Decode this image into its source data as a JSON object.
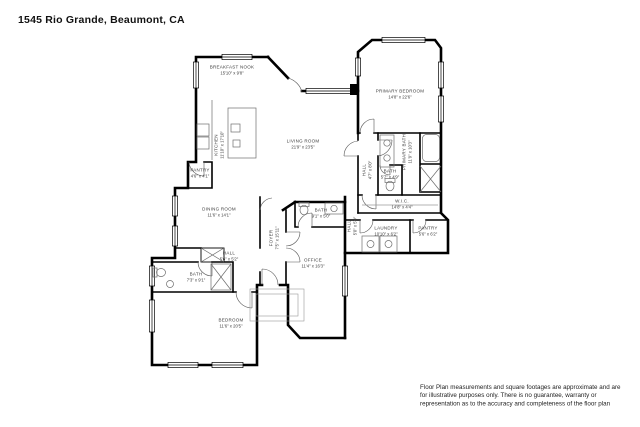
{
  "page": {
    "title": "1545 Rio Grande, Beaumont, CA",
    "disclaimer": "Floor Plan measurements and square footages are approximate and are for illustrative purposes only. There is no guarantee, warranty or representation as to the accuracy and completeness of the floor plan"
  },
  "colors": {
    "background": "#ffffff",
    "wall": "#000000",
    "label": "#3d3d3d",
    "fixture": "#6e6e6e"
  },
  "rooms": [
    {
      "name": "BREAKFAST NOOK",
      "dims": "15'10\" x 9'8\"",
      "x": 232,
      "y": 70,
      "rot": 0
    },
    {
      "name": "KITCHEN",
      "dims": "11'10\" x 17'10\"",
      "x": 219,
      "y": 145,
      "rot": -90
    },
    {
      "name": "LIVING ROOM",
      "dims": "21'9\" x 23'5\"",
      "x": 303,
      "y": 144,
      "rot": 0
    },
    {
      "name": "PRIMARY BEDROOM",
      "dims": "14'8\" x 22'6\"",
      "x": 400,
      "y": 94,
      "rot": 0
    },
    {
      "name": "HALL",
      "dims": "4'7\" x 8'0\"",
      "x": 367,
      "y": 170,
      "rot": -90
    },
    {
      "name": "PRIMARY BATH",
      "dims": "11'9\" x 10'3\"",
      "x": 407,
      "y": 152,
      "rot": -90
    },
    {
      "name": "BATH",
      "dims": "5'7\" x 4'9\"",
      "x": 390,
      "y": 174,
      "rot": 0
    },
    {
      "name": "W.I.C.",
      "dims": "14'8\" x 4'4\"",
      "x": 402,
      "y": 204,
      "rot": 0
    },
    {
      "name": "PANTRY",
      "dims": "4'6\" x 4'1\"",
      "x": 200,
      "y": 173,
      "rot": 0
    },
    {
      "name": "DINING ROOM",
      "dims": "11'6\" x 14'1\"",
      "x": 219,
      "y": 212,
      "rot": 0
    },
    {
      "name": "FOYER",
      "dims": "7'5\" x 15'11\"",
      "x": 274,
      "y": 238,
      "rot": -90
    },
    {
      "name": "BATH",
      "dims": "9'1\" x 5'0\"",
      "x": 321,
      "y": 213,
      "rot": 0
    },
    {
      "name": "HALL",
      "dims": "5'0\" x 5'9\"",
      "x": 352,
      "y": 226,
      "rot": -90
    },
    {
      "name": "LAUNDRY",
      "dims": "10'10\" x 6'2\"",
      "x": 386,
      "y": 231,
      "rot": 0
    },
    {
      "name": "PANTRY",
      "dims": "5'6\" x 6'2\"",
      "x": 428,
      "y": 231,
      "rot": 0
    },
    {
      "name": "HALL",
      "dims": "5'6\" x 5'2\"",
      "x": 229,
      "y": 256,
      "rot": 0
    },
    {
      "name": "OFFICE",
      "dims": "11'4\" x 16'3\"",
      "x": 313,
      "y": 263,
      "rot": 0
    },
    {
      "name": "BATH",
      "dims": "7'3\" x 9'1\"",
      "x": 196,
      "y": 277,
      "rot": 0
    },
    {
      "name": "BEDROOM",
      "dims": "11'6\" x 20'5\"",
      "x": 231,
      "y": 323,
      "rot": 0
    }
  ]
}
